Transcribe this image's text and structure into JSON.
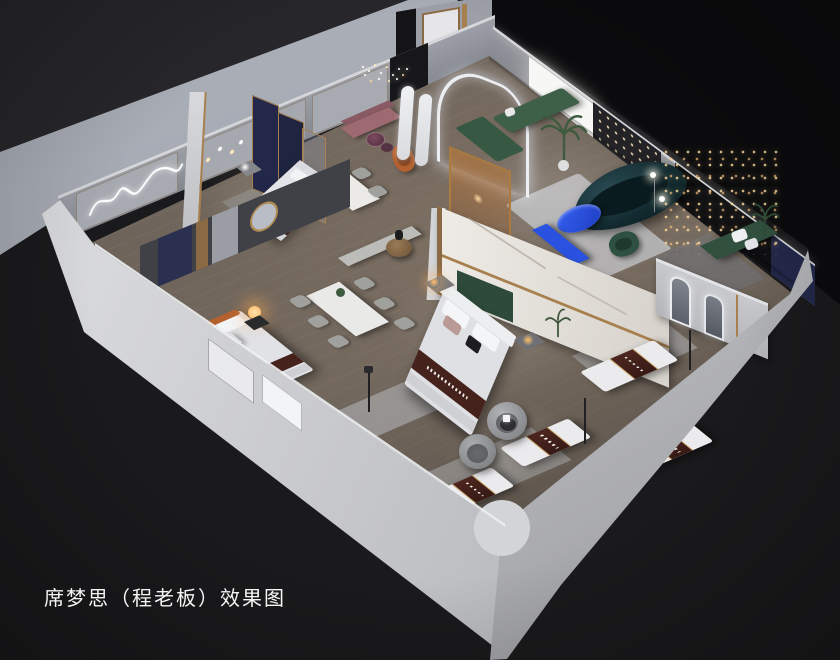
{
  "caption": {
    "text": "席梦思（程老板）效果图"
  },
  "palette": {
    "bg_dark": "#1a1a1c",
    "bg_darker": "#0b0b0d",
    "bg_topleft": "#27272b",
    "platform_hi": "#a9adb6",
    "platform_lo": "#868a93",
    "wall_face": "#9da0a8",
    "wall_face_dark": "#84878e",
    "wall_edge": "#d6d7da",
    "wall_front_hi": "#e2e3e6",
    "wall_front_lo": "#97989c",
    "floor": "#6d635a",
    "floor_dark": "#4e4843",
    "rug": "#c0c2c6",
    "rug_dim": "#a9acb2",
    "marble": "#ebe8e3",
    "gold": "#a7804e",
    "navy_panel": "#23284a",
    "accent_wall": "#0f0f12",
    "curtain": "#232327",
    "accent_blue": "#2a52e0",
    "blue_table": "#2e5bf0",
    "green_sofa": "#3e5f48",
    "green_dark": "#2c4a38",
    "teal_sofa": "#122a2f",
    "mauve": "#9d6a72",
    "orange_chair": "#b4612f",
    "amber_glass": "#b97a3f",
    "brown_runner": "#46221c",
    "mattress": "#ebebee",
    "wood_table": "#8a6b47",
    "chair_gray": "#a0a19d",
    "pod_gray": "#a3a4a6",
    "lamp_glow": "#ffc069",
    "led": "#f2f4f8",
    "text": "#f5f5f5"
  }
}
